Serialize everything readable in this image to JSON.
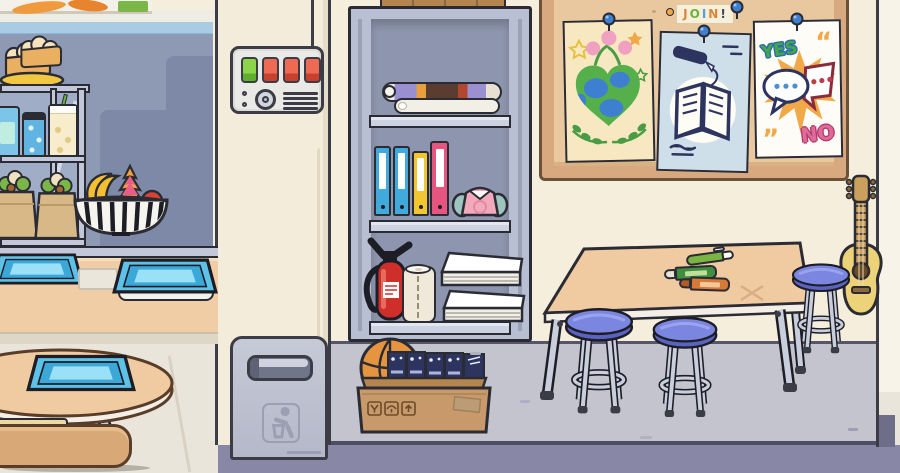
{
  "texts": {
    "join_letters": [
      "J",
      "O",
      "I",
      "N",
      "!"
    ],
    "yes": "YES",
    "no": "NO",
    "quote_open": "“",
    "quote_close": "„"
  },
  "objects": [
    "vegetable-poster",
    "display-shelf",
    "bread-plate",
    "soda-can",
    "juice-cup",
    "drink-jar",
    "wrap-bag",
    "fruit-bowl",
    "food-tray",
    "cafeteria-counter",
    "round-table",
    "bench",
    "control-panel",
    "trash-can",
    "storage-cabinet",
    "poster-rolls",
    "binders",
    "pink-bag",
    "fire-extinguisher",
    "paper-towel-roll",
    "paper-stacks",
    "storage-box",
    "basketball",
    "book-stack",
    "bulletin-board",
    "join-sign",
    "earth-poster",
    "book-poster",
    "yes-no-poster",
    "pushpins",
    "classroom-table",
    "green-pen",
    "green-marker",
    "orange-marker",
    "stool",
    "guitar"
  ],
  "colors": {
    "outline": "#2b2b34",
    "outlineSoft": "#3c3c46",
    "kitchenWall": "#8e9ab4",
    "kitchenWallShadow": "#7d89a6",
    "stripeBlue": "#a9cbe3",
    "bandWhite": "#efece3",
    "pillarCream": "#f3ecdb",
    "classWall": "#f5eedd",
    "rightWall": "#f8f3e8",
    "floorGray": "#c4c4ce",
    "floorLight": "#e9e5da",
    "floorBand": "#8887a5",
    "floorBandDark": "#6f6e88",
    "junction": "#56566b",
    "counterPeach": "#f1cda6",
    "counterBase": "#ded7c8",
    "steelFace": "#c2c8da",
    "steelSide": "#b9bfd2",
    "steelBack": "#8d96ae",
    "shelfBoard": "#ccd2e1",
    "trayRim": "#3ba8d8",
    "trayBlue": "#5ec1e8",
    "trayLight": "#9ae0f6",
    "tableTan": "#f0cba1",
    "tableEdge": "#f4efe6",
    "benchTan": "#d9a877",
    "benchPad": "#ecd9a4",
    "binderBlue": "#41aadc",
    "binderYellow": "#f2c630",
    "binderPink": "#e65580",
    "bagPink": "#f2a9bc",
    "bagTeal": "#9ec4c0",
    "extRed": "#cf2f2b",
    "towelCream": "#f0e9d9",
    "paperWhite": "#fbfaf6",
    "cardboard": "#c89a6b",
    "cardboardDark": "#8a6844",
    "cardboardFlap": "#b5854f",
    "ballOrange": "#e59540",
    "bookNavy": "#2e3460",
    "boardFrame": "#d8a87e",
    "boardInner": "#eac89f",
    "posterCream": "#f8e8c2",
    "posterBlue": "#cfdfea",
    "posterWhite": "#fdfcf7",
    "earthGreen": "#55b04c",
    "earthBlue": "#3f7fd0",
    "leafGreen": "#4a9c44",
    "tulipPink": "#f0a0c0",
    "starOrange": "#f0a84a",
    "starYellow": "#e8c040",
    "yesGreen": "#45a848",
    "yesOutline": "#2a6ab0",
    "noPink": "#e06a9a",
    "noOutline": "#b03a6a",
    "burstOrange": "#f0a848",
    "navyInk": "#2e3460",
    "maroonInk": "#8a2a3a",
    "dotBlue": "#4a90d0",
    "dotRed": "#c03a4a",
    "joinJ": "#e0833a",
    "joinO": "#69b43e",
    "joinI": "#56a0d8",
    "joinN": "#e0833a",
    "joinBang": "#3a4a6a",
    "stoolBlue": "#7b86e0",
    "stoolBlueDark": "#5a63c0",
    "stoolShine": "#9aa3ee",
    "metalLeg": "#c9cedc",
    "guitarBody": "#ecd37a",
    "guitarNeck": "#caa05c",
    "guitarHole": "#6b4a26",
    "panelFace": "#e9e9e5",
    "btnGreen": "#8ed44a",
    "btnGreenDark": "#5fae2e",
    "btnRed": "#ef6a52",
    "btnRedDark": "#c8402e",
    "binGray": "#bfc3d1",
    "binSlot": "#70768a",
    "binLine": "#9aa0b2",
    "pinBlue": "#3f7fd0",
    "canBlue": "#5fb4e2",
    "cupCream": "#f7eccb",
    "jarBlue": "#7cc4e8",
    "kraft": "#d9b887",
    "plateYellow": "#f2c741",
    "breadTan": "#e8b060",
    "breadCream": "#f6e2bc",
    "bananaYellow": "#f2c031",
    "dragonPink": "#e85d8a",
    "dragonOrange": "#f2a03c",
    "appleRed": "#d94436",
    "veggieGreen": "#7ab648",
    "penGreen": "#7ab543",
    "markGreen": "#3f8f3f",
    "markOrange": "#d87a36"
  }
}
